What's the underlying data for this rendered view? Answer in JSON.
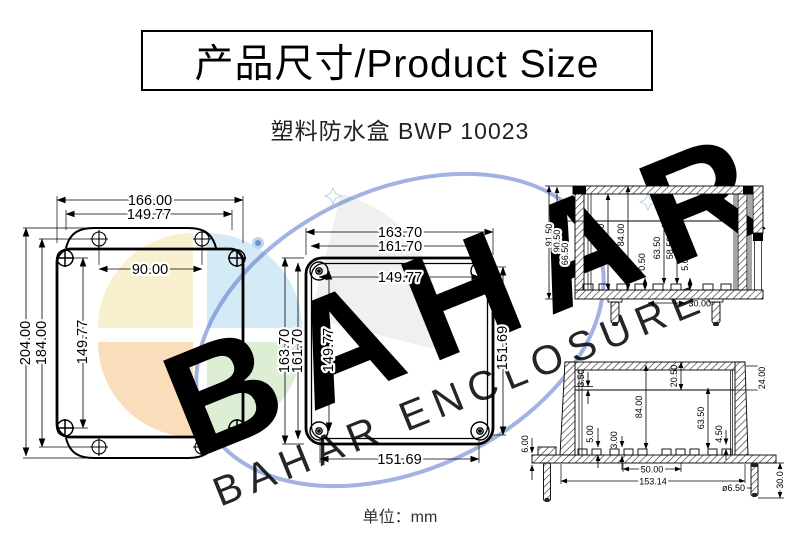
{
  "header": {
    "title": "产品尺寸/Product Size"
  },
  "product": {
    "subtitle": "塑料防水盒 BWP 10023"
  },
  "footer": {
    "unit_label": "单位：mm"
  },
  "watermark": {
    "brand": "BAHAR",
    "tagline": "BAHAR ENCLOSURE",
    "orbit_color": "#4565c6",
    "segment_colors": {
      "blue": "#cfe8f6",
      "cream": "#f8eecb",
      "orange": "#f9d9b4",
      "green": "#d9ecd0"
    }
  },
  "drawings": {
    "front_view": {
      "top_width_outer": "166.00",
      "top_width_inner": "149.77",
      "hole_spacing": "90.00",
      "height_outer": "204.00",
      "height_mid": "184.00",
      "screw_spacing_v": "149.77"
    },
    "lid_view": {
      "top_width_outer": "163.70",
      "top_width_inner": "161.70",
      "screw_spacing_h": "149.77",
      "height_outer": "163.70",
      "height_mid": "161.70",
      "screw_spacing_v": "149.77",
      "inner_height": "151.69",
      "inner_width": "151.69"
    },
    "side_section": {
      "total_height": "91.50",
      "body_height": "90.50",
      "inner_height": "66.50",
      "post_a": "79.00",
      "inner_depth": "84.00",
      "clearance": "0.50",
      "post_b": "63.50",
      "post_c": "58.50",
      "post_d": "5.00",
      "screw_offset": "30.00"
    },
    "front_section": {
      "lid_lip": "3.50",
      "lid_depth": "20.50",
      "lid_height": "24.00",
      "inner_depth": "84.00",
      "boss_height": "63.50",
      "boss_step": "4.50",
      "standoff_a": "5.00",
      "standoff_b": "3.00",
      "flange_thickness": "6.00",
      "standoff_spacing": "50.00",
      "mount_width": "153.14",
      "screw_diameter": "ø6.50",
      "screw_length": "30.0"
    }
  }
}
